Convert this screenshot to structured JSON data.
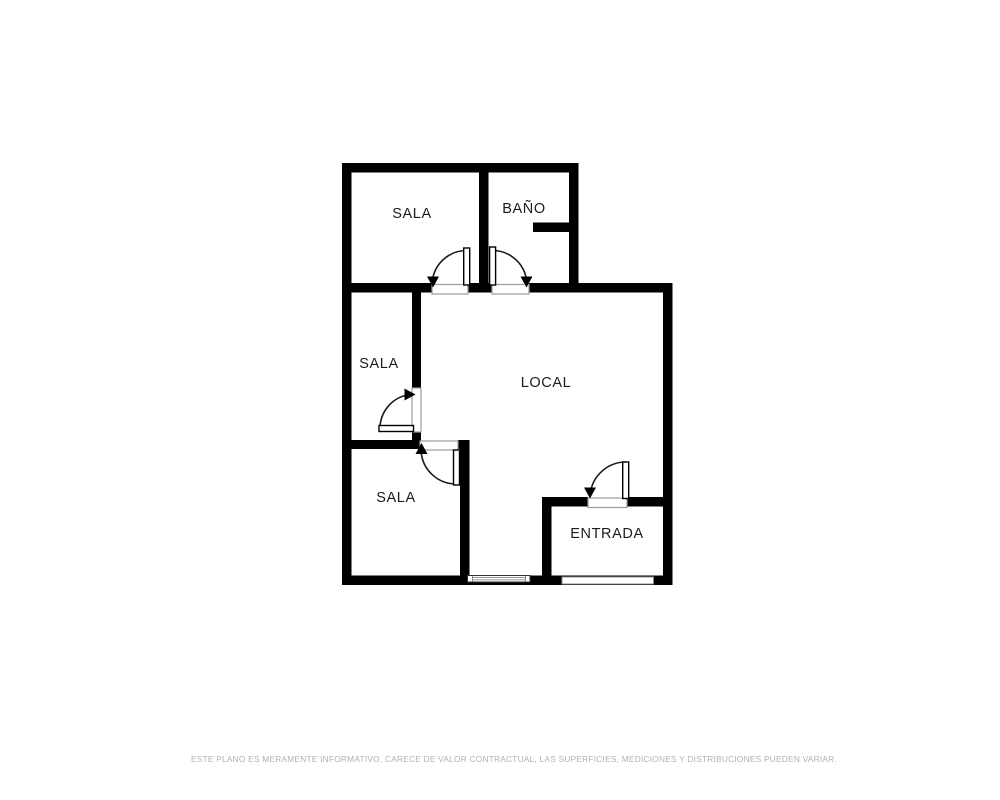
{
  "title": "Plano de vivienda / local",
  "colors": {
    "background": "#ffffff",
    "wall": "#000000",
    "label": "#1c1c1c",
    "disclaimer": "#b3b0b0"
  },
  "rooms": [
    {
      "id": "sala-top",
      "label": "SALA"
    },
    {
      "id": "bano",
      "label": "BAÑO"
    },
    {
      "id": "sala-middle",
      "label": "SALA"
    },
    {
      "id": "local",
      "label": "LOCAL"
    },
    {
      "id": "sala-bottom",
      "label": "SALA"
    },
    {
      "id": "entrada",
      "label": "ENTRADA"
    }
  ],
  "disclaimer": "ESTE PLANO ES MERAMENTE INFORMATIVO, CARECE DE VALOR CONTRACTUAL, LAS SUPERFICIES, MEDICIONES Y DISTRIBUCIONES PUEDEN VARIAR."
}
